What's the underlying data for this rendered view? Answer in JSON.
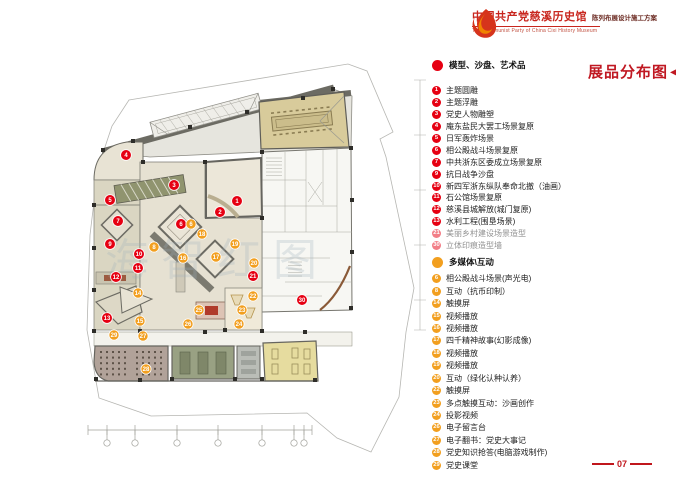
{
  "header": {
    "title_cn": "中国共产党慈溪历史馆",
    "subtitle_cn": "陈列布展设计施工方案",
    "title_en": "The Communist Party of China Cixi  History Museum"
  },
  "map_title": {
    "text": "展品分布图",
    "arrow_icon": "◀"
  },
  "page_number": "07",
  "watermark": "海智红图",
  "colors": {
    "red": "#e60012",
    "orange": "#f29f1f",
    "title_red": "#c8261e"
  },
  "legend": {
    "models_section": {
      "header": "模型、沙盘、艺术品",
      "color": "#e60012",
      "items": [
        {
          "num": "1",
          "label": "主题圆雕"
        },
        {
          "num": "2",
          "label": "主题浮雕"
        },
        {
          "num": "3",
          "label": "党史人物雕塑"
        },
        {
          "num": "4",
          "label": "庵东盐民大罢工场景复原"
        },
        {
          "num": "5",
          "label": "日军轰炸场景"
        },
        {
          "num": "6",
          "label": "相公殿战斗场景复原"
        },
        {
          "num": "7",
          "label": "中共浙东区委成立场景复原"
        },
        {
          "num": "9",
          "label": "抗日战争沙盘"
        },
        {
          "num": "10",
          "label": "新四军浙东纵队奉命北撤（油画）"
        },
        {
          "num": "11",
          "label": "石公馆场景复原"
        },
        {
          "num": "12",
          "label": "慈溪县城解放(城门复原)"
        },
        {
          "num": "13",
          "label": "水利工程(围垦场景)"
        },
        {
          "num": "21",
          "label": "美丽乡村建设场景造型",
          "faded": true
        },
        {
          "num": "30",
          "label": "立体印痕造型墙",
          "faded": true
        }
      ]
    },
    "multimedia_section": {
      "header": "多媒体\\互动",
      "color": "#f29f1f",
      "items": [
        {
          "num": "6",
          "label": "相公殿战斗场景(声光电)"
        },
        {
          "num": "8",
          "label": "互动（抗币印制）"
        },
        {
          "num": "14",
          "label": "触摸屏"
        },
        {
          "num": "15",
          "label": "视频播放"
        },
        {
          "num": "16",
          "label": "视频播放"
        },
        {
          "num": "17",
          "label": "四千精神故事(幻影成像)"
        },
        {
          "num": "18",
          "label": "视频播放"
        },
        {
          "num": "19",
          "label": "视频播放"
        },
        {
          "num": "20",
          "label": "互动（绿化认种认养）"
        },
        {
          "num": "22",
          "label": "触摸屏"
        },
        {
          "num": "23",
          "label": "多点触摸互动：沙画创作"
        },
        {
          "num": "24",
          "label": "投影视频"
        },
        {
          "num": "26",
          "label": "电子留言台"
        },
        {
          "num": "27",
          "label": "电子翻书：党史大事记"
        },
        {
          "num": "28",
          "label": "党史知识抢答(电脑游戏制作)"
        },
        {
          "num": "29",
          "label": "党史课堂"
        }
      ]
    }
  },
  "plan_markers": {
    "models": [
      {
        "n": "1",
        "x": 237,
        "y": 201
      },
      {
        "n": "2",
        "x": 220,
        "y": 212
      },
      {
        "n": "3",
        "x": 174,
        "y": 185
      },
      {
        "n": "4",
        "x": 126,
        "y": 155
      },
      {
        "n": "5",
        "x": 110,
        "y": 200
      },
      {
        "n": "6",
        "x": 181,
        "y": 224
      },
      {
        "n": "7",
        "x": 118,
        "y": 221
      },
      {
        "n": "9",
        "x": 110,
        "y": 244
      },
      {
        "n": "10",
        "x": 139,
        "y": 254
      },
      {
        "n": "11",
        "x": 138,
        "y": 268
      },
      {
        "n": "12",
        "x": 116,
        "y": 277
      },
      {
        "n": "13",
        "x": 107,
        "y": 318
      },
      {
        "n": "21",
        "x": 253,
        "y": 276
      },
      {
        "n": "30",
        "x": 302,
        "y": 300
      }
    ],
    "multimedia": [
      {
        "n": "6",
        "x": 191,
        "y": 224
      },
      {
        "n": "8",
        "x": 154,
        "y": 247
      },
      {
        "n": "14",
        "x": 138,
        "y": 293
      },
      {
        "n": "15",
        "x": 140,
        "y": 321
      },
      {
        "n": "16",
        "x": 183,
        "y": 258
      },
      {
        "n": "17",
        "x": 216,
        "y": 257
      },
      {
        "n": "18",
        "x": 202,
        "y": 234
      },
      {
        "n": "19",
        "x": 235,
        "y": 244
      },
      {
        "n": "20",
        "x": 254,
        "y": 263
      },
      {
        "n": "22",
        "x": 253,
        "y": 296
      },
      {
        "n": "23",
        "x": 242,
        "y": 310
      },
      {
        "n": "24",
        "x": 239,
        "y": 324
      },
      {
        "n": "25",
        "x": 199,
        "y": 310
      },
      {
        "n": "26",
        "x": 188,
        "y": 324
      },
      {
        "n": "27",
        "x": 143,
        "y": 336
      },
      {
        "n": "28",
        "x": 146,
        "y": 369
      },
      {
        "n": "29",
        "x": 114,
        "y": 335
      }
    ]
  }
}
